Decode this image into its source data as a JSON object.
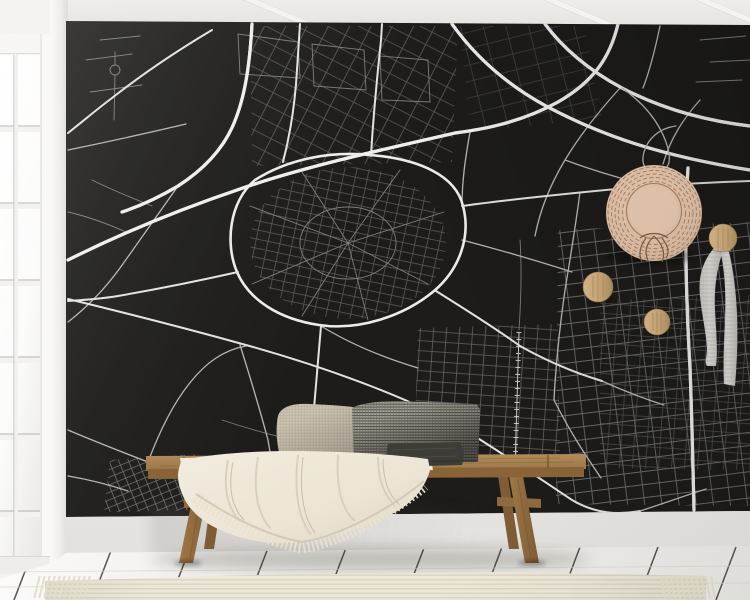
{
  "meta": {
    "description": "Interior photo mockup: black city-map wall mural in a bright room with white plank floor, a window at left, a wooden bench with woven pillows and a fringed cream throw, a straw hat and a scarf hanging on wooden wall pegs, and a ribbed cream runner rug."
  },
  "colors": {
    "map-bg": "#1d1c1a",
    "street-minor": "#7d7d7d",
    "street-medium": "#b5b5b5",
    "street-major": "#ececec",
    "ceiling": "#e9e8e4",
    "wall-white": "#efeeeb",
    "floor": "#f0efec",
    "plank-gap": "#39372f",
    "rug": "#e9e3d4",
    "bench-wood": "#a57f4e",
    "bench-wood-dark": "#7c5a34",
    "blanket": "#ece5d5",
    "pillow-beige": "#cdc5b4",
    "pillow-gray": "#a8a59d",
    "pillow-charcoal": "#3e3c36",
    "hat-straw": "#d8bba4",
    "hat-ring": "#8f6a4a",
    "peg-wood": "#c2a274",
    "scarf": "#cac8c3"
  },
  "scene": {
    "wall_mural": {
      "name": "city-map-wall-mural",
      "style": "white streets on black"
    },
    "window": {
      "name": "white-frame-window",
      "panes": "gridded, overexposed daylight"
    },
    "decor": {
      "hat": {
        "name": "straw-hat"
      },
      "pegs": [
        {
          "name": "wooden-peg"
        },
        {
          "name": "wooden-peg"
        },
        {
          "name": "wooden-peg"
        }
      ],
      "scarf": {
        "name": "hanging-scarf"
      }
    },
    "bench": {
      "name": "wooden-bench",
      "legs": 4,
      "stretchers": 2
    },
    "pillows": [
      {
        "name": "beige-woven-pillow"
      },
      {
        "name": "gray-checkered-lumbar-pillow"
      },
      {
        "name": "charcoal-pillow"
      }
    ],
    "blanket": {
      "name": "cream-fringed-throw"
    },
    "rug": {
      "name": "ribbed-cream-runner-rug",
      "fringe": "both ends"
    },
    "floor": {
      "name": "white-plank-floor"
    }
  }
}
